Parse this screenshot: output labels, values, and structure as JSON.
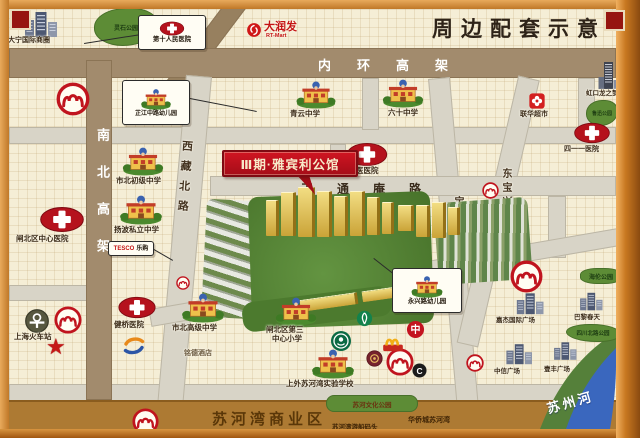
{
  "title": "周边配套示意",
  "property": {
    "callout": "Ⅲ期·雅宾利公馆"
  },
  "roads": {
    "inner_ring": "内环高架",
    "north_south": "南北高架",
    "xizang_north": "西藏北路",
    "tiantongan": "天通庵路",
    "zhongxing": "中兴路",
    "dongbaoxing": "东宝兴路",
    "baotong": "宝通路"
  },
  "hospitals": {
    "tenth_people": "第十人民医院",
    "zhabei_central": "闸北区中心医院",
    "shanghai_tcm": "上海市中医医院",
    "h411": "四一一医院",
    "jianqiao": "健桥医院"
  },
  "schools": {
    "zhijiang_kindergarten": "芷江中路幼儿园",
    "qingyun_middle": "青云中学",
    "sixty_middle": "六十中学",
    "shibei_junior": "市北初级中学",
    "yangbo_private": "扬波私立中学",
    "shibei_senior": "市北高级中学",
    "no3_primary_line1": "闸北区第三",
    "no3_primary_line2": "中心小学",
    "sisu_suhewan": "上外苏河湾实验学校",
    "yongxing_kindergarten": "永兴路幼儿园"
  },
  "shopping": {
    "daning_circle": "大宁国际商圈",
    "rt_mart": "大润发",
    "rt_mart_en": "RT-Mart",
    "tesco": "TESCO",
    "tesco_cn": "乐购",
    "lianhua": "联华超市",
    "longemont": "虹口龙之梦",
    "jiajie_plaza": "嘉杰国际广场",
    "printemps": "巴黎春天",
    "zhongxin_plaza": "中信广场",
    "yifeng_plaza": "壹丰广场",
    "mingde_hotel": "铭德酒店"
  },
  "parks": {
    "lingshi": "灵石公园",
    "luxun": "鲁迅公园",
    "hailun": "海伦公园",
    "sichuan_north": "四川北路公园",
    "suhe_culture": "苏河文化公园"
  },
  "landmarks": {
    "railway_station": "上海火车站",
    "suzhou_river": "苏州河",
    "suhewan_biz": "苏河湾商业区",
    "cruise_dock": "苏河湾游船码头",
    "oct_suhewan": "华侨城苏河湾"
  },
  "icons": {
    "boc_glyph": "中",
    "bocom_glyph": "C",
    "star_glyph": "★"
  },
  "colors": {
    "frame": "#c9813a",
    "accent_red": "#b5121d",
    "elevated_road": "#a28b6d",
    "street": "#d8d4c7",
    "background": "#f5eed6",
    "band": "#ad7a33",
    "river": "#3a67be",
    "park": "#5d8c36"
  }
}
